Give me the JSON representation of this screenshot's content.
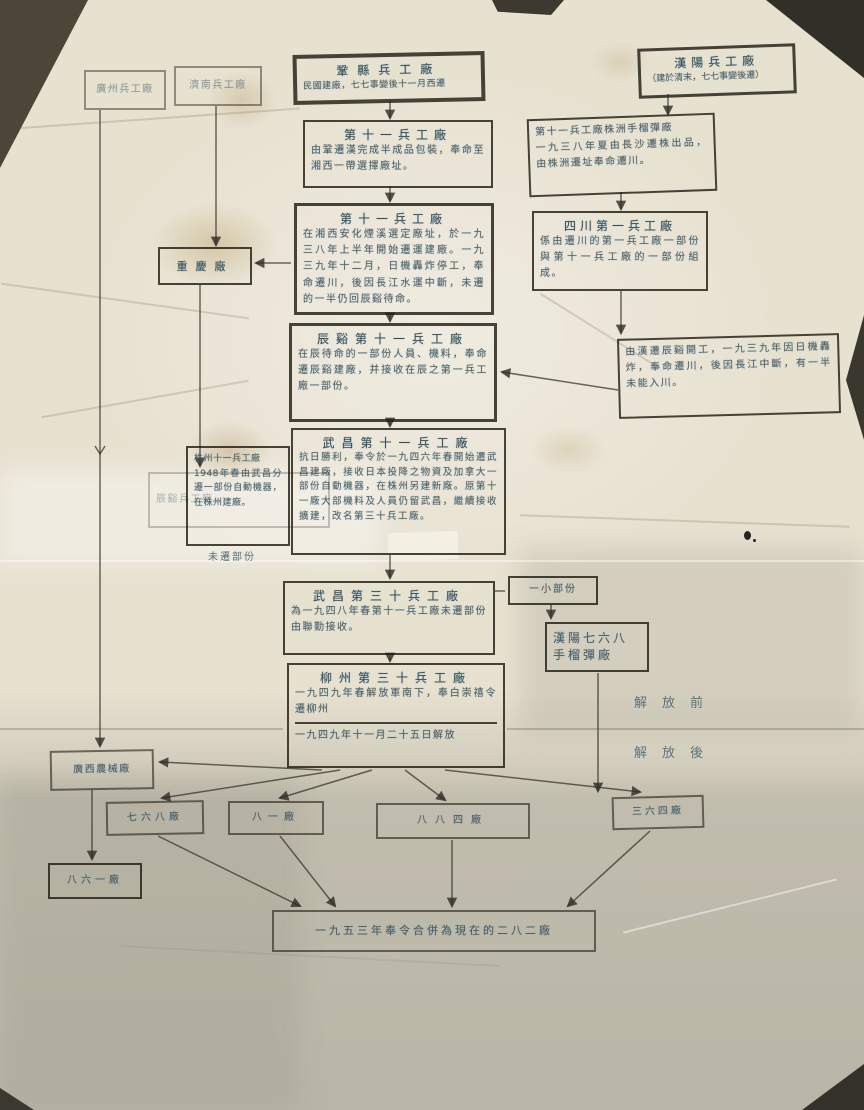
{
  "colors": {
    "ink": "#39596a",
    "paper": "#e7e1d0",
    "paper_shadow": "#b5b2a4",
    "box_border": "#24211a"
  },
  "diagram": {
    "era": {
      "before": "解放前",
      "after": "解放後"
    },
    "nodes": {
      "guangzhou": {
        "title": "廣州兵工廠"
      },
      "jinan": {
        "title": "濟南兵工廠"
      },
      "gongxian": {
        "title": "鞏縣兵工廠",
        "subtitle": "民國建廠，七七事變後十一月西遷"
      },
      "hanyang": {
        "title": "漢陽兵工廠",
        "subtitle": "（建於清末，七七事變後遷）"
      },
      "arsenal11_han": {
        "title": "第十一兵工廠",
        "body": "由鞏遷漢完成半成品包裝，奉命至湘西一帶選擇廠址。"
      },
      "zhuzhou_grenade": {
        "title": "第十一兵工廠株洲手榴彈廠",
        "body": "一九三八年夏由長沙遷株出品，由株洲遷址奉命遷川。"
      },
      "arsenal11_yanxi": {
        "title": "第十一兵工廠",
        "body": "在湘西安化煙溪選定廠址，於一九三八年上半年開始遷運建廠。一九三九年十二月，日機轟炸停工，奉命遷川，後因長江水運中斷，未遷的一半仍回辰谿待命。"
      },
      "chongqing": {
        "title": "重慶廠"
      },
      "sichuan1": {
        "title": "四川第一兵工廠",
        "body": "係由遷川的第一兵工廠一部份與第十一兵工廠的一部份組成。"
      },
      "chenxi11": {
        "title": "辰谿第十一兵工廠",
        "body": "在辰待命的一部份人員、機料，奉命遷辰谿建廠，并接收在辰之第一兵工廠一部份。"
      },
      "note_chuan": {
        "body": "由漢遷辰谿開工，一九三九年因日機轟炸，奉命遷川，後因長江中斷，有一半未能入川。"
      },
      "wuchang11": {
        "title": "武昌第十一兵工廠",
        "body": "抗日勝利，奉令於一九四六年春開始遷武昌建廠，接收日本投降之物資及加拿大一部份自動機器，在株州另建新廠。原第十一廠大部機料及人員仍留武昌，繼續接收擴建，改名第三十兵工廠。"
      },
      "chenxi_plant": {
        "title": "辰谿兵工廠"
      },
      "zhuzhou11": {
        "title": "株州十一兵工廠",
        "body": "1948年春由武昌分遷一部份自動機器，在株州建廠。",
        "label_below": "未遷部份"
      },
      "wuchang30": {
        "title": "武昌第三十兵工廠",
        "body": "為一九四八年春第十一兵工廠未遷部份由聯勤接收。"
      },
      "small_part": {
        "title": "一小部份"
      },
      "grenade768": {
        "title": "漢陽七六八手榴彈廠"
      },
      "liuzhou30": {
        "title": "柳州第三十兵工廠",
        "body": "一九四九年春解放軍南下，奉白崇禧令遷柳州",
        "note": "一九四九年十一月二十五日解放"
      },
      "nongxie": {
        "title": "廣西農械廠"
      },
      "f768": {
        "title": "七六八廠"
      },
      "f81": {
        "title": "八一廠"
      },
      "f884": {
        "title": "八八四廠"
      },
      "f364": {
        "title": "三六四廠"
      },
      "f861": {
        "title": "八六一廠"
      },
      "merge1953": {
        "title": "一九五三年奉令合併為現在的二八二廠"
      }
    }
  }
}
